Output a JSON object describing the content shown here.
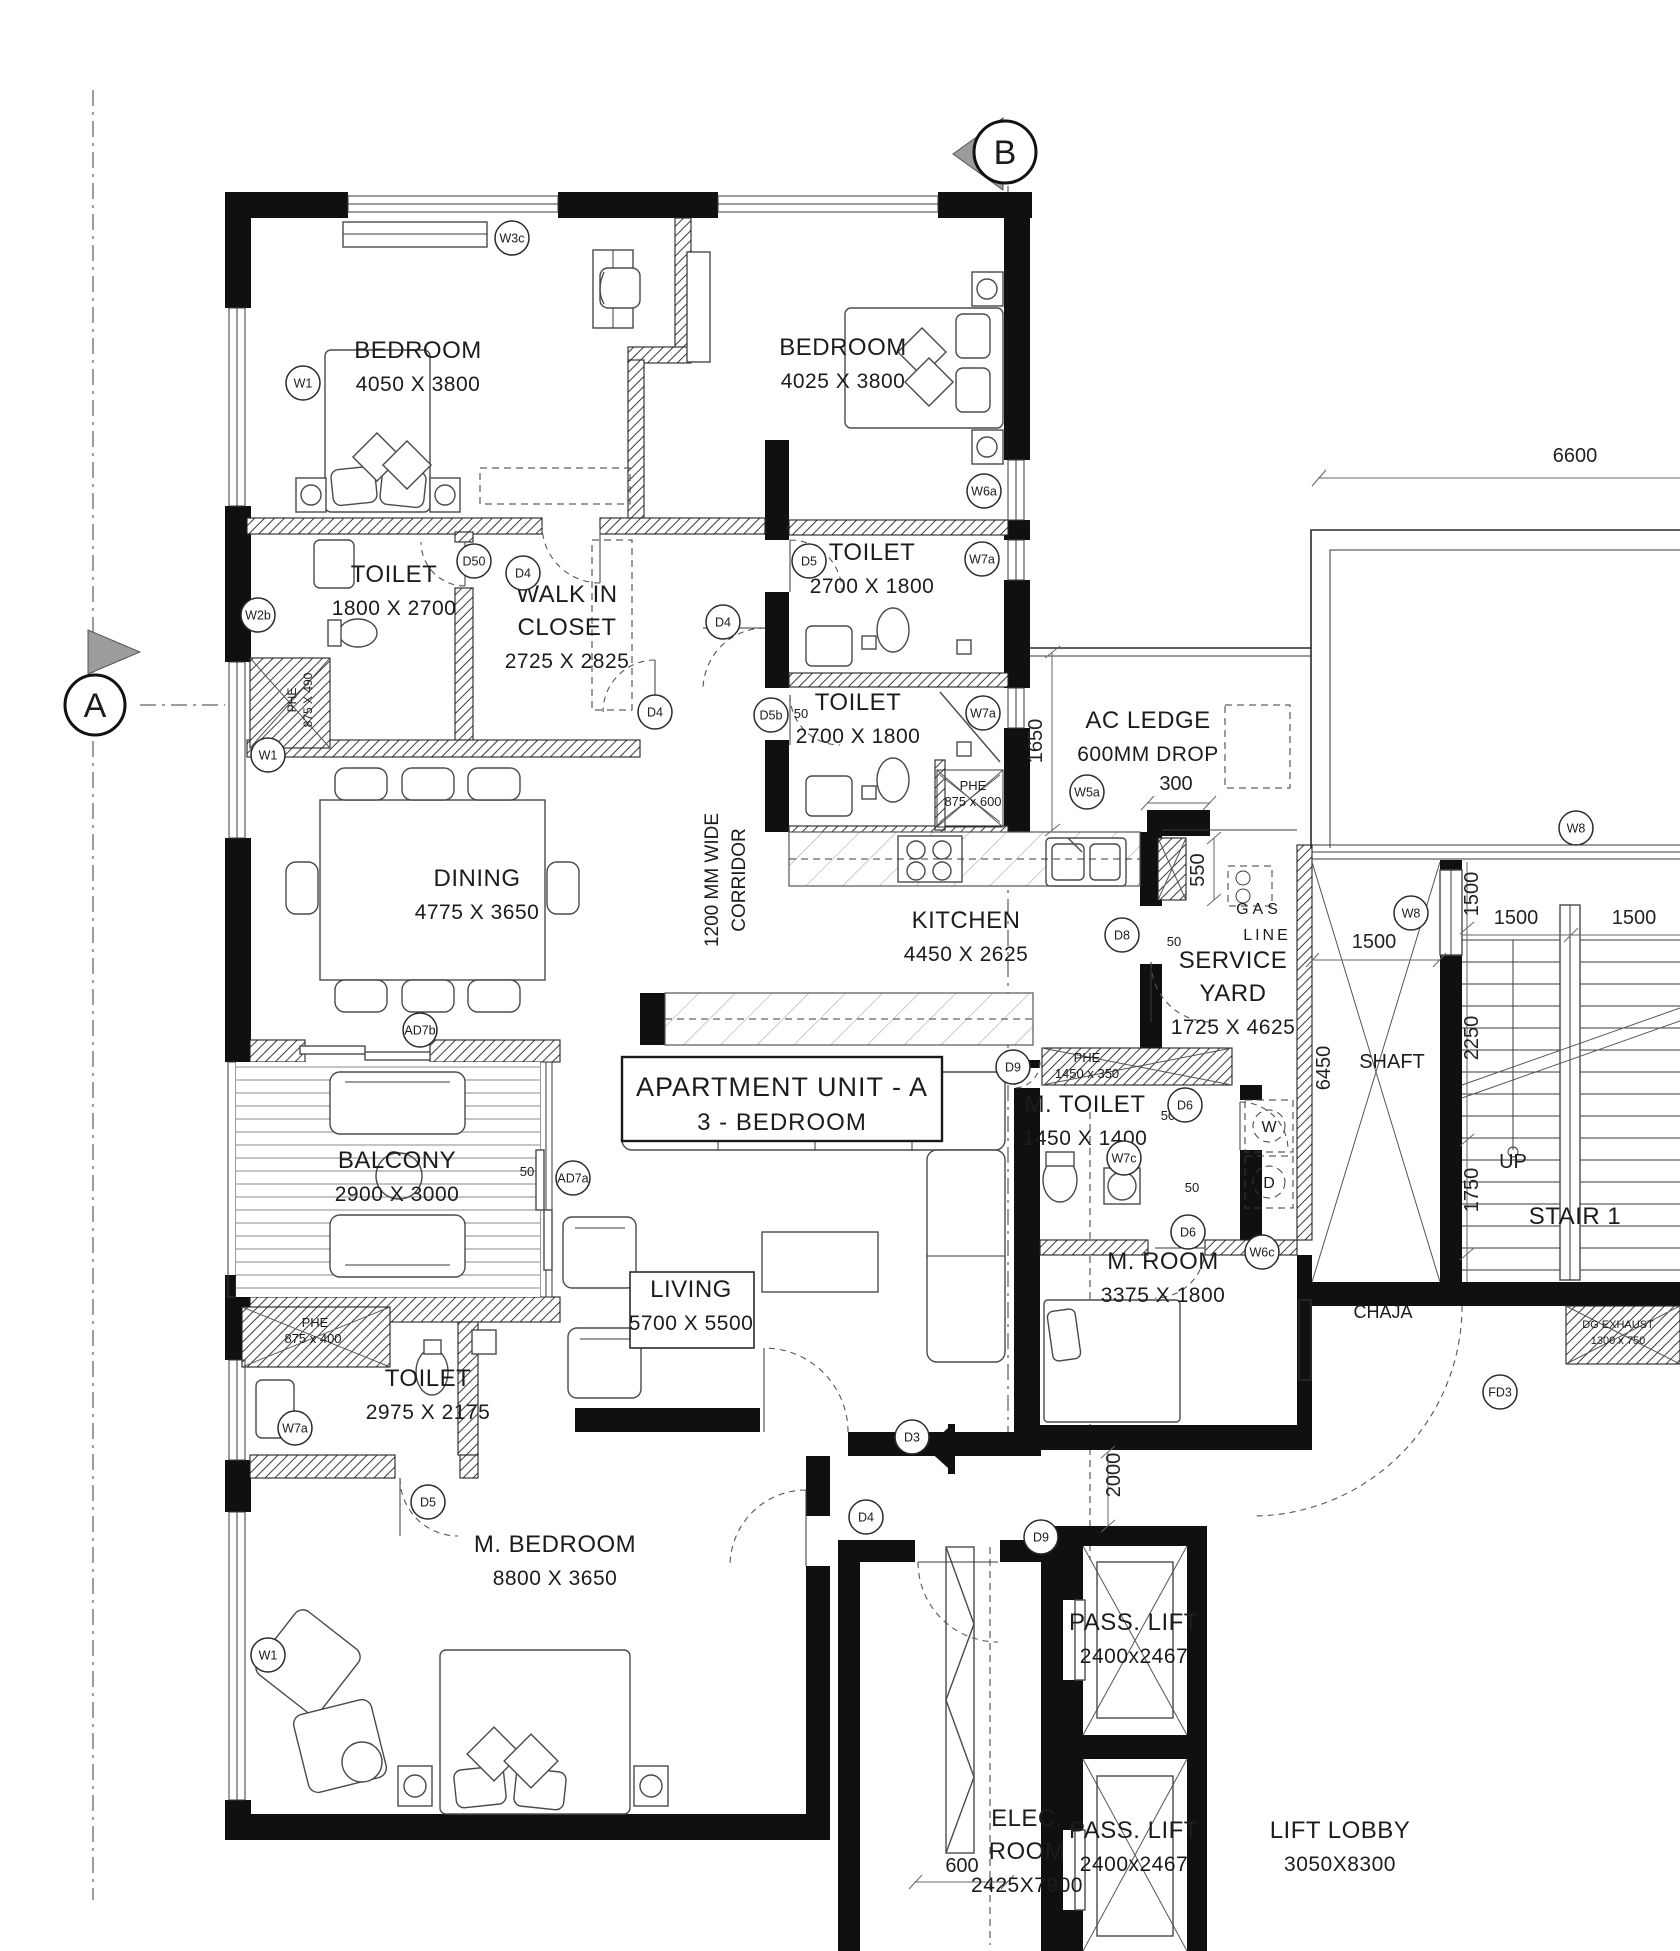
{
  "unit": {
    "title": "APARTMENT UNIT - A",
    "subtitle": "3 - BEDROOM"
  },
  "markers": [
    {
      "label": "A",
      "x": 95,
      "y": 705,
      "r": 30,
      "tri": "right"
    },
    {
      "label": "B",
      "x": 1005,
      "y": 152,
      "r": 31,
      "tri": "left"
    }
  ],
  "rooms": [
    {
      "name": [
        "BEDROOM"
      ],
      "dims": "4050 X 3800",
      "x": 418,
      "y": 358
    },
    {
      "name": [
        "BEDROOM"
      ],
      "dims": "4025 X 3800",
      "x": 843,
      "y": 355
    },
    {
      "name": [
        "TOILET"
      ],
      "dims": "1800 X 2700",
      "x": 394,
      "y": 582
    },
    {
      "name": [
        "WALK IN",
        "CLOSET"
      ],
      "dims": "2725 X 2825",
      "x": 567,
      "y": 602
    },
    {
      "name": [
        "TOILET"
      ],
      "dims": "2700 X 1800",
      "x": 872,
      "y": 560
    },
    {
      "name": [
        "TOILET"
      ],
      "dims": "2700 X 1800",
      "x": 858,
      "y": 710
    },
    {
      "name": [
        "AC LEDGE"
      ],
      "dims": "600MM DROP",
      "x": 1148,
      "y": 728
    },
    {
      "name": [
        "DINING"
      ],
      "dims": "4775 X 3650",
      "x": 477,
      "y": 886
    },
    {
      "name": [
        "KITCHEN"
      ],
      "dims": "4450 X 2625",
      "x": 966,
      "y": 928
    },
    {
      "name": [
        "SERVICE",
        "YARD"
      ],
      "dims": "1725 X 4625",
      "x": 1233,
      "y": 968
    },
    {
      "name": [
        "M. TOILET"
      ],
      "dims": "1450 X 1400",
      "x": 1085,
      "y": 1112
    },
    {
      "name": [
        "BALCONY"
      ],
      "dims": "2900 X 3000",
      "x": 397,
      "y": 1168
    },
    {
      "name": [
        "LIVING"
      ],
      "dims": "5700 X 5500",
      "x": 691,
      "y": 1297
    },
    {
      "name": [
        "M. ROOM"
      ],
      "dims": "3375 X 1800",
      "x": 1163,
      "y": 1269
    },
    {
      "name": [
        "TOILET"
      ],
      "dims": "2975 X 2175",
      "x": 428,
      "y": 1386
    },
    {
      "name": [
        "M. BEDROOM"
      ],
      "dims": "8800 X 3650",
      "x": 555,
      "y": 1552
    },
    {
      "name": [
        "STAIR 1"
      ],
      "dims": "",
      "x": 1575,
      "y": 1224
    },
    {
      "name": [
        "PASS. LIFT"
      ],
      "dims": "2400x2467",
      "x": 1134,
      "y": 1630
    },
    {
      "name": [
        "PASS. LIFT"
      ],
      "dims": "2400x2467",
      "x": 1134,
      "y": 1838
    },
    {
      "name": [
        "ELEC.",
        "ROOM"
      ],
      "dims": "2425X7900",
      "x": 1027,
      "y": 1826
    },
    {
      "name": [
        "LIFT LOBBY"
      ],
      "dims": "3050X8300",
      "x": 1340,
      "y": 1838
    }
  ],
  "labels": [
    {
      "t": "1200 MM WIDE",
      "x": 718,
      "y": 880,
      "s": 19,
      "rot": 270
    },
    {
      "t": "CORRIDOR",
      "x": 745,
      "y": 880,
      "s": 19,
      "rot": 270
    },
    {
      "t": "GAS",
      "x": 1259,
      "y": 914,
      "s": 16,
      "ls": 4
    },
    {
      "t": "LINE",
      "x": 1267,
      "y": 940,
      "s": 16,
      "ls": 3
    },
    {
      "t": "SHAFT",
      "x": 1392,
      "y": 1068,
      "s": 20
    },
    {
      "t": "CHAJA",
      "x": 1383,
      "y": 1318,
      "s": 18
    },
    {
      "t": "UP",
      "x": 1513,
      "y": 1168,
      "s": 20
    },
    {
      "t": "W",
      "x": 1269,
      "y": 1132,
      "s": 16
    },
    {
      "t": "D",
      "x": 1269,
      "y": 1188,
      "s": 16
    },
    {
      "t": "PHE",
      "x": 973,
      "y": 790,
      "s": 13
    },
    {
      "t": "875 x 600",
      "x": 973,
      "y": 806,
      "s": 13
    },
    {
      "t": "PHE",
      "x": 296,
      "y": 700,
      "s": 12,
      "rot": 270
    },
    {
      "t": "875 X 490",
      "x": 312,
      "y": 700,
      "s": 12,
      "rot": 270
    },
    {
      "t": "PHE",
      "x": 1087,
      "y": 1062,
      "s": 13
    },
    {
      "t": "1450 x 350",
      "x": 1087,
      "y": 1078,
      "s": 13
    },
    {
      "t": "PHE",
      "x": 315,
      "y": 1327,
      "s": 13
    },
    {
      "t": "875 x 400",
      "x": 313,
      "y": 1343,
      "s": 13
    },
    {
      "t": "DG EXHAUST",
      "x": 1618,
      "y": 1328,
      "s": 11
    },
    {
      "t": "1300 x 750",
      "x": 1618,
      "y": 1344,
      "s": 11
    },
    {
      "t": "50",
      "x": 801,
      "y": 718,
      "s": 13
    },
    {
      "t": "50",
      "x": 527,
      "y": 1176,
      "s": 13
    },
    {
      "t": "50",
      "x": 1174,
      "y": 946,
      "s": 13
    },
    {
      "t": "50",
      "x": 1168,
      "y": 1120,
      "s": 13
    },
    {
      "t": "50",
      "x": 1192,
      "y": 1192,
      "s": 13
    }
  ],
  "tags": [
    {
      "t": "W3c",
      "x": 512,
      "y": 238
    },
    {
      "t": "W1",
      "x": 303,
      "y": 383
    },
    {
      "t": "W2b",
      "x": 258,
      "y": 615
    },
    {
      "t": "D50",
      "x": 474,
      "y": 561
    },
    {
      "t": "D4",
      "x": 523,
      "y": 573
    },
    {
      "t": "D5",
      "x": 809,
      "y": 561
    },
    {
      "t": "W7a",
      "x": 982,
      "y": 559
    },
    {
      "t": "W6a",
      "x": 984,
      "y": 491
    },
    {
      "t": "D4",
      "x": 723,
      "y": 622
    },
    {
      "t": "D4",
      "x": 655,
      "y": 712
    },
    {
      "t": "D5b",
      "x": 771,
      "y": 715
    },
    {
      "t": "W7a",
      "x": 983,
      "y": 713
    },
    {
      "t": "W5a",
      "x": 1087,
      "y": 792
    },
    {
      "t": "W1",
      "x": 268,
      "y": 755
    },
    {
      "t": "AD7b",
      "x": 420,
      "y": 1030
    },
    {
      "t": "AD7a",
      "x": 573,
      "y": 1178
    },
    {
      "t": "D8",
      "x": 1122,
      "y": 935
    },
    {
      "t": "D9",
      "x": 1013,
      "y": 1067
    },
    {
      "t": "D6",
      "x": 1185,
      "y": 1105
    },
    {
      "t": "W7c",
      "x": 1124,
      "y": 1158
    },
    {
      "t": "D6",
      "x": 1188,
      "y": 1232
    },
    {
      "t": "W6c",
      "x": 1262,
      "y": 1252
    },
    {
      "t": "W8",
      "x": 1411,
      "y": 913
    },
    {
      "t": "W8",
      "x": 1576,
      "y": 828
    },
    {
      "t": "D3",
      "x": 912,
      "y": 1437
    },
    {
      "t": "D4",
      "x": 866,
      "y": 1517
    },
    {
      "t": "D9",
      "x": 1041,
      "y": 1537
    },
    {
      "t": "W7a",
      "x": 295,
      "y": 1428
    },
    {
      "t": "D5",
      "x": 428,
      "y": 1502
    },
    {
      "t": "W1",
      "x": 268,
      "y": 1655
    },
    {
      "t": "FD3",
      "x": 1500,
      "y": 1392
    }
  ],
  "dimensions": [
    {
      "t": "6600",
      "x": 1575,
      "y": 462
    },
    {
      "t": "1650",
      "x": 1042,
      "y": 741,
      "rot": 270
    },
    {
      "t": "300",
      "x": 1176,
      "y": 790
    },
    {
      "t": "550",
      "x": 1204,
      "y": 870,
      "rot": 270
    },
    {
      "t": "1500",
      "x": 1374,
      "y": 948
    },
    {
      "t": "1500",
      "x": 1478,
      "y": 894,
      "rot": 270
    },
    {
      "t": "1500",
      "x": 1516,
      "y": 924
    },
    {
      "t": "1500",
      "x": 1634,
      "y": 924
    },
    {
      "t": "2250",
      "x": 1478,
      "y": 1038,
      "rot": 270
    },
    {
      "t": "1750",
      "x": 1478,
      "y": 1190,
      "rot": 270
    },
    {
      "t": "6450",
      "x": 1330,
      "y": 1068,
      "rot": 270
    },
    {
      "t": "2000",
      "x": 1120,
      "y": 1475,
      "rot": 270
    },
    {
      "t": "600",
      "x": 962,
      "y": 1872
    }
  ]
}
